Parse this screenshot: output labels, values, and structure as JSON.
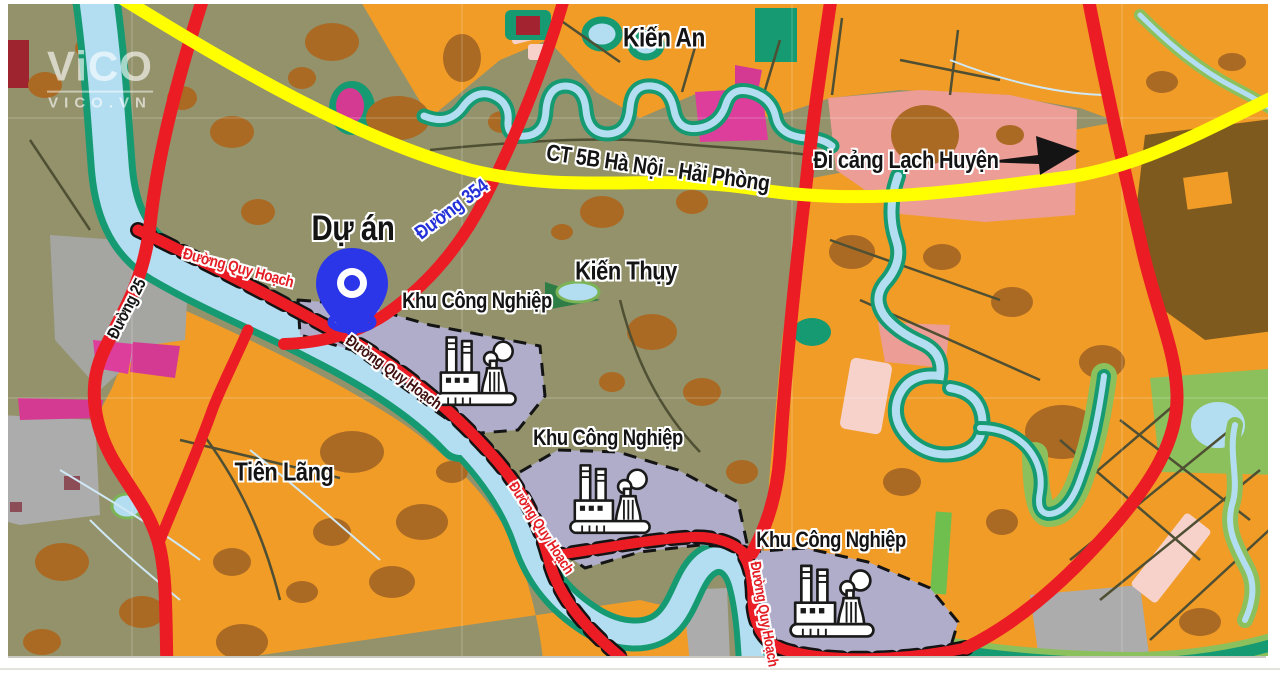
{
  "map": {
    "type": "planning-map",
    "logo": {
      "line1": "ViCO",
      "line2": "VICO.VN"
    },
    "colors": {
      "background_olive": "#93926B",
      "farmland_orange": "#F19C27",
      "patch_brown": "#AA6A23",
      "dark_brown": "#7E5A1E",
      "road_red": "#EC1C24",
      "highway_yellow": "#FFFF00",
      "river_blue": "#B3DEF2",
      "river_teal": "#169A72",
      "green_zone": "#8CC05C",
      "industrial_lavender": "#AFADCA",
      "urban_salmon": "#EC9D96",
      "magenta": "#D53A92",
      "bright_pink": "#DD3D9B",
      "light_pink": "#F6D2CB",
      "gray_zone": "#ACACAC",
      "maroon": "#8C4D57",
      "pin_blue": "#2B36E8",
      "label_blue": "#2430D8"
    },
    "icons": [
      {
        "name": "location-pin",
        "meaning": "project site marker"
      },
      {
        "name": "factory-icon",
        "meaning": "industrial park (Khu Công Nghiệp)"
      },
      {
        "name": "direction-arrow-icon",
        "meaning": "direction to Lạch Huyện port"
      }
    ],
    "labels": [
      {
        "id": "kien-an",
        "text": "Kiến An",
        "x": 664,
        "y": 38,
        "rot": 0,
        "color": "#141414",
        "size": 27
      },
      {
        "id": "ct5b",
        "text": "CT 5B Hà Nội - Hải Phòng",
        "x": 658,
        "y": 168,
        "rot": 8,
        "color": "#141414",
        "size": 23
      },
      {
        "id": "di-cang",
        "text": "Đi cảng Lạch Huyện",
        "x": 906,
        "y": 161,
        "rot": 0,
        "color": "#141414",
        "size": 24
      },
      {
        "id": "du-an",
        "text": "Dự án",
        "x": 353,
        "y": 229,
        "rot": 0,
        "color": "#141414",
        "size": 35
      },
      {
        "id": "duong-354",
        "text": "Đường 354",
        "x": 452,
        "y": 210,
        "rot": -37,
        "color": "#2430D8",
        "size": 20
      },
      {
        "id": "duong-25",
        "text": "Đường 25",
        "x": 127,
        "y": 309,
        "rot": -63,
        "color": "#141414",
        "size": 17
      },
      {
        "id": "qh-1",
        "text": "Đường Quy Hoạch",
        "x": 238,
        "y": 269,
        "rot": 15,
        "color": "#E31E25",
        "size": 16
      },
      {
        "id": "qh-2",
        "text": "Đường Quy Hoạch",
        "x": 393,
        "y": 373,
        "rot": 36,
        "color": "#401010",
        "size": 16
      },
      {
        "id": "qh-3",
        "text": "Đường Quy Hoạch",
        "x": 541,
        "y": 528,
        "rot": 57,
        "color": "#E31E25",
        "size": 15
      },
      {
        "id": "qh-4",
        "text": "Đường Quy Hoạch",
        "x": 764,
        "y": 614,
        "rot": 80,
        "color": "#E31E25",
        "size": 15
      },
      {
        "id": "kien-thuy",
        "text": "Kiến Thụy",
        "x": 626,
        "y": 271,
        "rot": 0,
        "color": "#141414",
        "size": 26
      },
      {
        "id": "kcn-1",
        "text": "Khu Công Nghiệp",
        "x": 477,
        "y": 301,
        "rot": 0,
        "color": "#141414",
        "size": 22
      },
      {
        "id": "kcn-2",
        "text": "Khu Công Nghiệp",
        "x": 608,
        "y": 438,
        "rot": 0,
        "color": "#141414",
        "size": 22
      },
      {
        "id": "kcn-3",
        "text": "Khu Công Nghiệp",
        "x": 831,
        "y": 540,
        "rot": 0,
        "color": "#141414",
        "size": 22
      },
      {
        "id": "tien-lang",
        "text": "Tiên Lãng",
        "x": 284,
        "y": 472,
        "rot": 0,
        "color": "#141414",
        "size": 26
      }
    ]
  }
}
